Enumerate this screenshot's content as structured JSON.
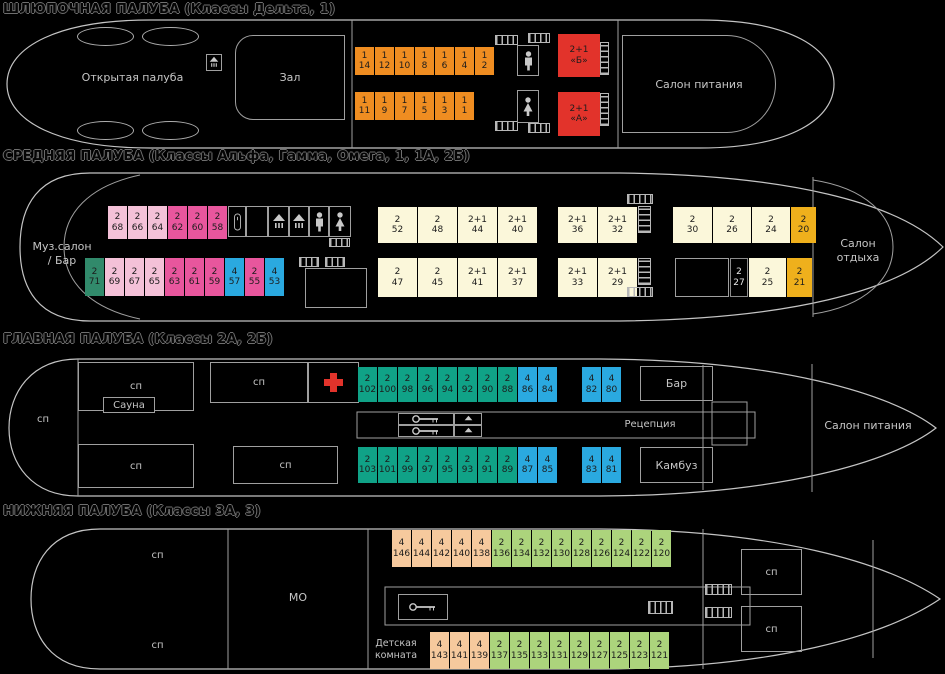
{
  "palette": {
    "orange": "#ef8d21",
    "red": "#e2332b",
    "light_pink": "#f4c1d8",
    "pink": "#e8569d",
    "teal_dark": "#318a6b",
    "blue": "#2aa9e0",
    "cream": "#fbf7da",
    "gold": "#efb01c",
    "teal": "#10a287",
    "peach": "#f6c99d",
    "green": "#acd47c",
    "dark": "#000000"
  },
  "boat": {
    "title": "ШЛЮПОЧНАЯ ПАЛУБА (Классы Дельта, 1)",
    "open_deck_label": "Открытая палуба",
    "hall_label": "Зал",
    "dining_label": "Салон питания",
    "rows": {
      "top": [
        {
          "cap": "1",
          "num": "14",
          "type": "orange"
        },
        {
          "cap": "1",
          "num": "12",
          "type": "orange"
        },
        {
          "cap": "1",
          "num": "10",
          "type": "orange"
        },
        {
          "cap": "1",
          "num": "8",
          "type": "orange"
        },
        {
          "cap": "1",
          "num": "6",
          "type": "orange"
        },
        {
          "cap": "1",
          "num": "4",
          "type": "orange"
        },
        {
          "cap": "1",
          "num": "2",
          "type": "orange"
        }
      ],
      "bottom": [
        {
          "cap": "1",
          "num": "11",
          "type": "orange"
        },
        {
          "cap": "1",
          "num": "9",
          "type": "orange"
        },
        {
          "cap": "1",
          "num": "7",
          "type": "orange"
        },
        {
          "cap": "1",
          "num": "5",
          "type": "orange"
        },
        {
          "cap": "1",
          "num": "3",
          "type": "orange"
        },
        {
          "cap": "1",
          "num": "1",
          "type": "orange"
        }
      ],
      "suite_b": [
        {
          "cap": "2+1",
          "num": "«Б»",
          "type": "red",
          "w": 42
        }
      ],
      "suite_a": [
        {
          "cap": "2+1",
          "num": "«А»",
          "type": "red",
          "w": 42
        }
      ]
    }
  },
  "middle": {
    "title": "СРЕДНЯЯ ПАЛУБА (Классы Альфа, Гамма, Омега, 1, 1А, 2Б)",
    "music_salon_line1": "Муз.салон",
    "music_salon_line2": "/ Бар",
    "rest_salon_line1": "Салон",
    "rest_salon_line2": "отдыха",
    "rows": {
      "top_left": [
        {
          "cap": "2",
          "num": "68",
          "type": "light_pink"
        },
        {
          "cap": "2",
          "num": "66",
          "type": "light_pink"
        },
        {
          "cap": "2",
          "num": "64",
          "type": "light_pink"
        },
        {
          "cap": "2",
          "num": "62",
          "type": "pink"
        },
        {
          "cap": "2",
          "num": "60",
          "type": "pink"
        },
        {
          "cap": "2",
          "num": "58",
          "type": "pink"
        }
      ],
      "bottom_left": [
        {
          "cap": "2",
          "num": "71",
          "type": "teal_dark"
        },
        {
          "cap": "2",
          "num": "69",
          "type": "light_pink"
        },
        {
          "cap": "2",
          "num": "67",
          "type": "light_pink"
        },
        {
          "cap": "2",
          "num": "65",
          "type": "light_pink"
        },
        {
          "cap": "2",
          "num": "63",
          "type": "pink"
        },
        {
          "cap": "2",
          "num": "61",
          "type": "pink"
        },
        {
          "cap": "2",
          "num": "59",
          "type": "pink"
        },
        {
          "cap": "4",
          "num": "57",
          "type": "blue"
        },
        {
          "cap": "2",
          "num": "55",
          "type": "pink"
        },
        {
          "cap": "4",
          "num": "53",
          "type": "blue"
        }
      ],
      "top_mid1": [
        {
          "cap": "2",
          "num": "52",
          "type": "cream",
          "w": 39
        },
        {
          "cap": "2",
          "num": "48",
          "type": "cream",
          "w": 39
        },
        {
          "cap": "2+1",
          "num": "44",
          "type": "cream",
          "w": 39
        },
        {
          "cap": "2+1",
          "num": "40",
          "type": "cream",
          "w": 39
        }
      ],
      "top_mid2": [
        {
          "cap": "2+1",
          "num": "36",
          "type": "cream",
          "w": 39
        },
        {
          "cap": "2+1",
          "num": "32",
          "type": "cream",
          "w": 39
        }
      ],
      "top_right": [
        {
          "cap": "2",
          "num": "30",
          "type": "cream",
          "w": 39
        },
        {
          "cap": "2",
          "num": "26",
          "type": "cream",
          "w": 38
        },
        {
          "cap": "2",
          "num": "24",
          "type": "cream",
          "w": 38
        },
        {
          "cap": "2",
          "num": "20",
          "type": "gold",
          "w": 25
        }
      ],
      "bottom_mid1": [
        {
          "cap": "2",
          "num": "47",
          "type": "cream",
          "w": 39
        },
        {
          "cap": "2",
          "num": "45",
          "type": "cream",
          "w": 39
        },
        {
          "cap": "2+1",
          "num": "41",
          "type": "cream",
          "w": 39
        },
        {
          "cap": "2+1",
          "num": "37",
          "type": "cream",
          "w": 39
        }
      ],
      "bottom_mid2": [
        {
          "cap": "2+1",
          "num": "33",
          "type": "cream",
          "w": 39
        },
        {
          "cap": "2+1",
          "num": "29",
          "type": "cream",
          "w": 39
        }
      ],
      "bottom_right": [
        {
          "cap": "2",
          "num": "27",
          "type": "dark",
          "w": 18
        },
        {
          "cap": "2",
          "num": "25",
          "type": "cream",
          "w": 37
        },
        {
          "cap": "2",
          "num": "21",
          "type": "gold",
          "w": 25
        }
      ]
    }
  },
  "main": {
    "title": "ГЛАВНАЯ ПАЛУБА (Классы 2А, 2Б)",
    "sp_label": "сп",
    "sauna_label": "Сауна",
    "bar_label": "Бар",
    "reception_label": "Рецепция",
    "galley_label": "Камбуз",
    "dining_label": "Салон питания",
    "rows": {
      "top1": [
        {
          "cap": "2",
          "num": "102",
          "type": "teal"
        },
        {
          "cap": "2",
          "num": "100",
          "type": "teal"
        },
        {
          "cap": "2",
          "num": "98",
          "type": "teal"
        },
        {
          "cap": "2",
          "num": "96",
          "type": "teal"
        },
        {
          "cap": "2",
          "num": "94",
          "type": "teal"
        },
        {
          "cap": "2",
          "num": "92",
          "type": "teal"
        },
        {
          "cap": "2",
          "num": "90",
          "type": "teal"
        },
        {
          "cap": "2",
          "num": "88",
          "type": "teal"
        },
        {
          "cap": "4",
          "num": "86",
          "type": "blue"
        },
        {
          "cap": "4",
          "num": "84",
          "type": "blue"
        }
      ],
      "top2": [
        {
          "cap": "4",
          "num": "82",
          "type": "blue"
        },
        {
          "cap": "4",
          "num": "80",
          "type": "blue"
        }
      ],
      "bottom1": [
        {
          "cap": "2",
          "num": "103",
          "type": "teal"
        },
        {
          "cap": "2",
          "num": "101",
          "type": "teal"
        },
        {
          "cap": "2",
          "num": "99",
          "type": "teal"
        },
        {
          "cap": "2",
          "num": "97",
          "type": "teal"
        },
        {
          "cap": "2",
          "num": "95",
          "type": "teal"
        },
        {
          "cap": "2",
          "num": "93",
          "type": "teal"
        },
        {
          "cap": "2",
          "num": "91",
          "type": "teal"
        },
        {
          "cap": "2",
          "num": "89",
          "type": "teal"
        },
        {
          "cap": "4",
          "num": "87",
          "type": "blue"
        },
        {
          "cap": "4",
          "num": "85",
          "type": "blue"
        }
      ],
      "bottom2": [
        {
          "cap": "4",
          "num": "83",
          "type": "blue"
        },
        {
          "cap": "4",
          "num": "81",
          "type": "blue"
        }
      ]
    }
  },
  "lower": {
    "title": "НИЖНЯЯ ПАЛУБА (Классы 3А, 3)",
    "sp_label": "сп",
    "engine_label": "МО",
    "kids_line1": "Детская",
    "kids_line2": "комната",
    "rows": {
      "top": [
        {
          "cap": "4",
          "num": "146",
          "type": "peach"
        },
        {
          "cap": "4",
          "num": "144",
          "type": "peach"
        },
        {
          "cap": "4",
          "num": "142",
          "type": "peach"
        },
        {
          "cap": "4",
          "num": "140",
          "type": "peach"
        },
        {
          "cap": "4",
          "num": "138",
          "type": "peach"
        },
        {
          "cap": "2",
          "num": "136",
          "type": "green"
        },
        {
          "cap": "2",
          "num": "134",
          "type": "green"
        },
        {
          "cap": "2",
          "num": "132",
          "type": "green"
        },
        {
          "cap": "2",
          "num": "130",
          "type": "green"
        },
        {
          "cap": "2",
          "num": "128",
          "type": "green"
        },
        {
          "cap": "2",
          "num": "126",
          "type": "green"
        },
        {
          "cap": "2",
          "num": "124",
          "type": "green"
        },
        {
          "cap": "2",
          "num": "122",
          "type": "green"
        },
        {
          "cap": "2",
          "num": "120",
          "type": "green"
        }
      ],
      "bottom": [
        {
          "cap": "4",
          "num": "143",
          "type": "peach"
        },
        {
          "cap": "4",
          "num": "141",
          "type": "peach"
        },
        {
          "cap": "4",
          "num": "139",
          "type": "peach"
        },
        {
          "cap": "2",
          "num": "137",
          "type": "green"
        },
        {
          "cap": "2",
          "num": "135",
          "type": "green"
        },
        {
          "cap": "2",
          "num": "133",
          "type": "green"
        },
        {
          "cap": "2",
          "num": "131",
          "type": "green"
        },
        {
          "cap": "2",
          "num": "129",
          "type": "green"
        },
        {
          "cap": "2",
          "num": "127",
          "type": "green"
        },
        {
          "cap": "2",
          "num": "125",
          "type": "green"
        },
        {
          "cap": "2",
          "num": "123",
          "type": "green"
        },
        {
          "cap": "2",
          "num": "121",
          "type": "green"
        }
      ]
    }
  }
}
